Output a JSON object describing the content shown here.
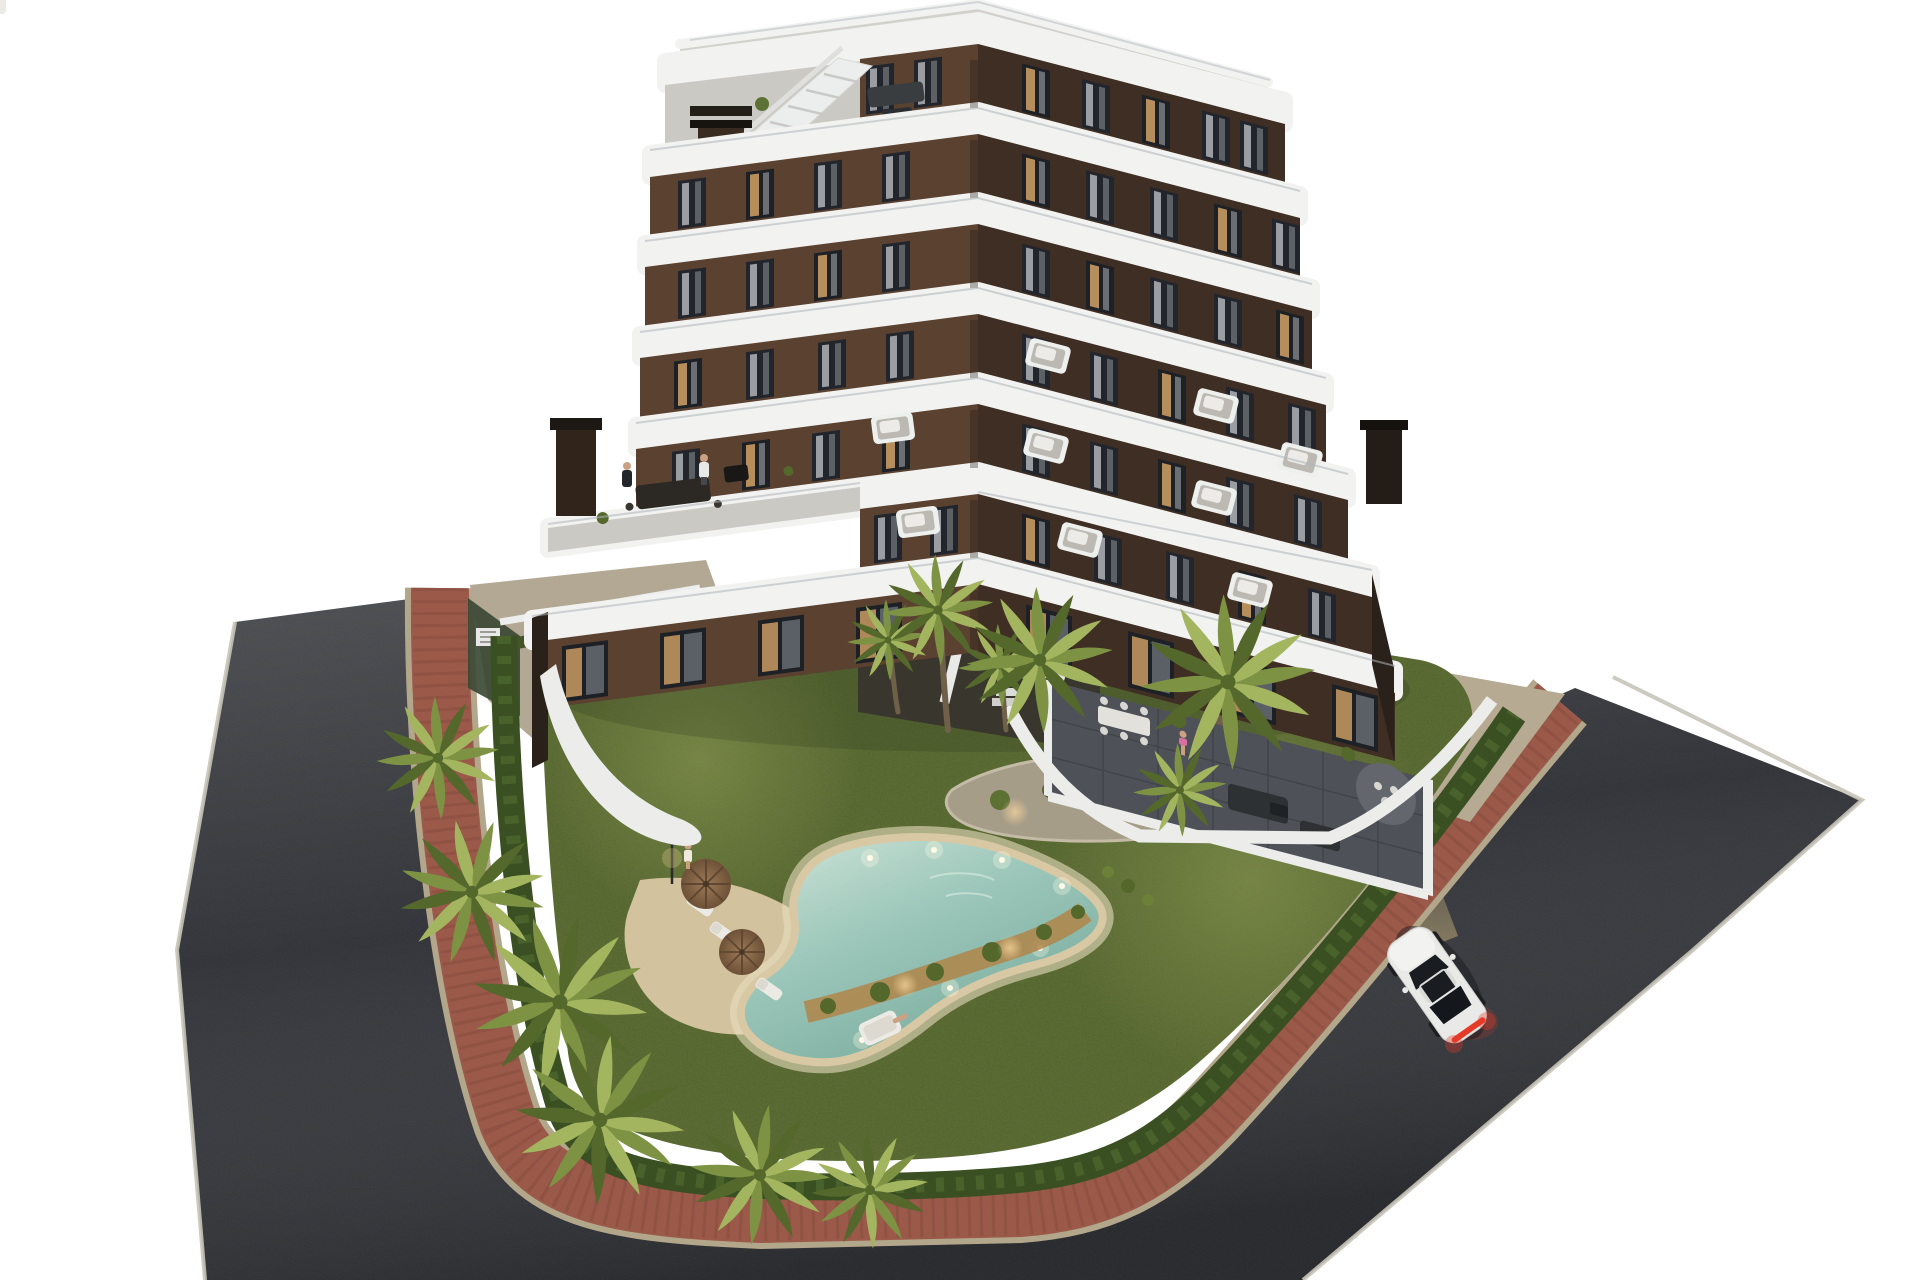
{
  "scene": {
    "kind": "architectural-3d-render",
    "description": "Aerial dusk rendering of a modern 7-storey apartment building with curved white balcony bands, rooftop terrace with plunge pool, landscaped communal garden with free-form swimming pool, palm trees, wrap-around red brick sidewalk, asphalt streets and a single white sports car driving by",
    "time_of_day": "dusk"
  },
  "colors": {
    "background": "#ffffff",
    "asphalt": "#34363b",
    "asphalt_dark": "#2b2d31",
    "road_curb": "#c8c4b8",
    "sidewalk_brick": "#9b594a",
    "sidewalk_joint": "#7c4437",
    "curb": "#b3a78b",
    "apron_left": "#b2a894",
    "apron_right": "#b6aa92",
    "lawn": "#5f7036",
    "lawn_light": "#78884a",
    "hedge": "#3a5022",
    "hedge_light": "#4e662e",
    "palm": "#7d9343",
    "palm_light": "#a3b55f",
    "palm_dark": "#55682c",
    "palm_trunk": "#6f6049",
    "deck_sand": "#d2c29e",
    "pool_rim": "#d8c9a4",
    "pool_rim_glow": "#e8ddc0",
    "planting_warm": "#b08549",
    "pool_water": "#9cc7ba",
    "pool_water_deep": "#79ab9d",
    "pool_water_light": "#cfe4d8",
    "rooftop_pool": "#bcd9da",
    "band_white": "#f2f2f0",
    "band_shade": "#d9dad8",
    "deck_gray": "#cbc9c4",
    "roof_deck": "#d2d1cc",
    "facade_left": "#5a4130",
    "facade_right": "#3f2e23",
    "facade_deep": "#2a211a",
    "window_glass": "#22262c",
    "window_lit": "#c89a62",
    "curtain": "#b9bdc1",
    "patio_tile": "#4e5157",
    "patio_tile_dark": "#3c3f44",
    "wall_white": "#ecedeb",
    "furniture_dark": "#2e3134",
    "sofa_white": "#e8e6e1",
    "umbrella": "#8a6848",
    "umbrella_dark": "#5f4731",
    "car_body": "#e9e9e7",
    "car_glass": "#191c21",
    "taillight": "#e63a28",
    "headlight_beam": "#c8b078",
    "glass_rail": "#aeb6ba",
    "skin": "#caa183",
    "bikini_pink": "#d96fa0"
  },
  "counts": {
    "building_floors": 7,
    "cars": 1,
    "parasols": 2,
    "sun_loungers": 5,
    "large_palm_trees": 12,
    "people_visible": 6,
    "swimming_pools": 2
  },
  "people": [
    {
      "location": "rooftop-terrace"
    },
    {
      "location": "fifth-floor-terrace",
      "detail": "woman in dark dress"
    },
    {
      "location": "fifth-floor-terrace",
      "detail": "man in white shirt"
    },
    {
      "location": "garden-lawn",
      "detail": "standing by pool deck"
    },
    {
      "location": "pool-sofa",
      "detail": "lying down"
    },
    {
      "location": "ground-patio",
      "detail": "person in pink swimsuit"
    }
  ],
  "car": {
    "color": "white",
    "lights": "taillights and headlights on",
    "heading": "up the street toward the building"
  }
}
